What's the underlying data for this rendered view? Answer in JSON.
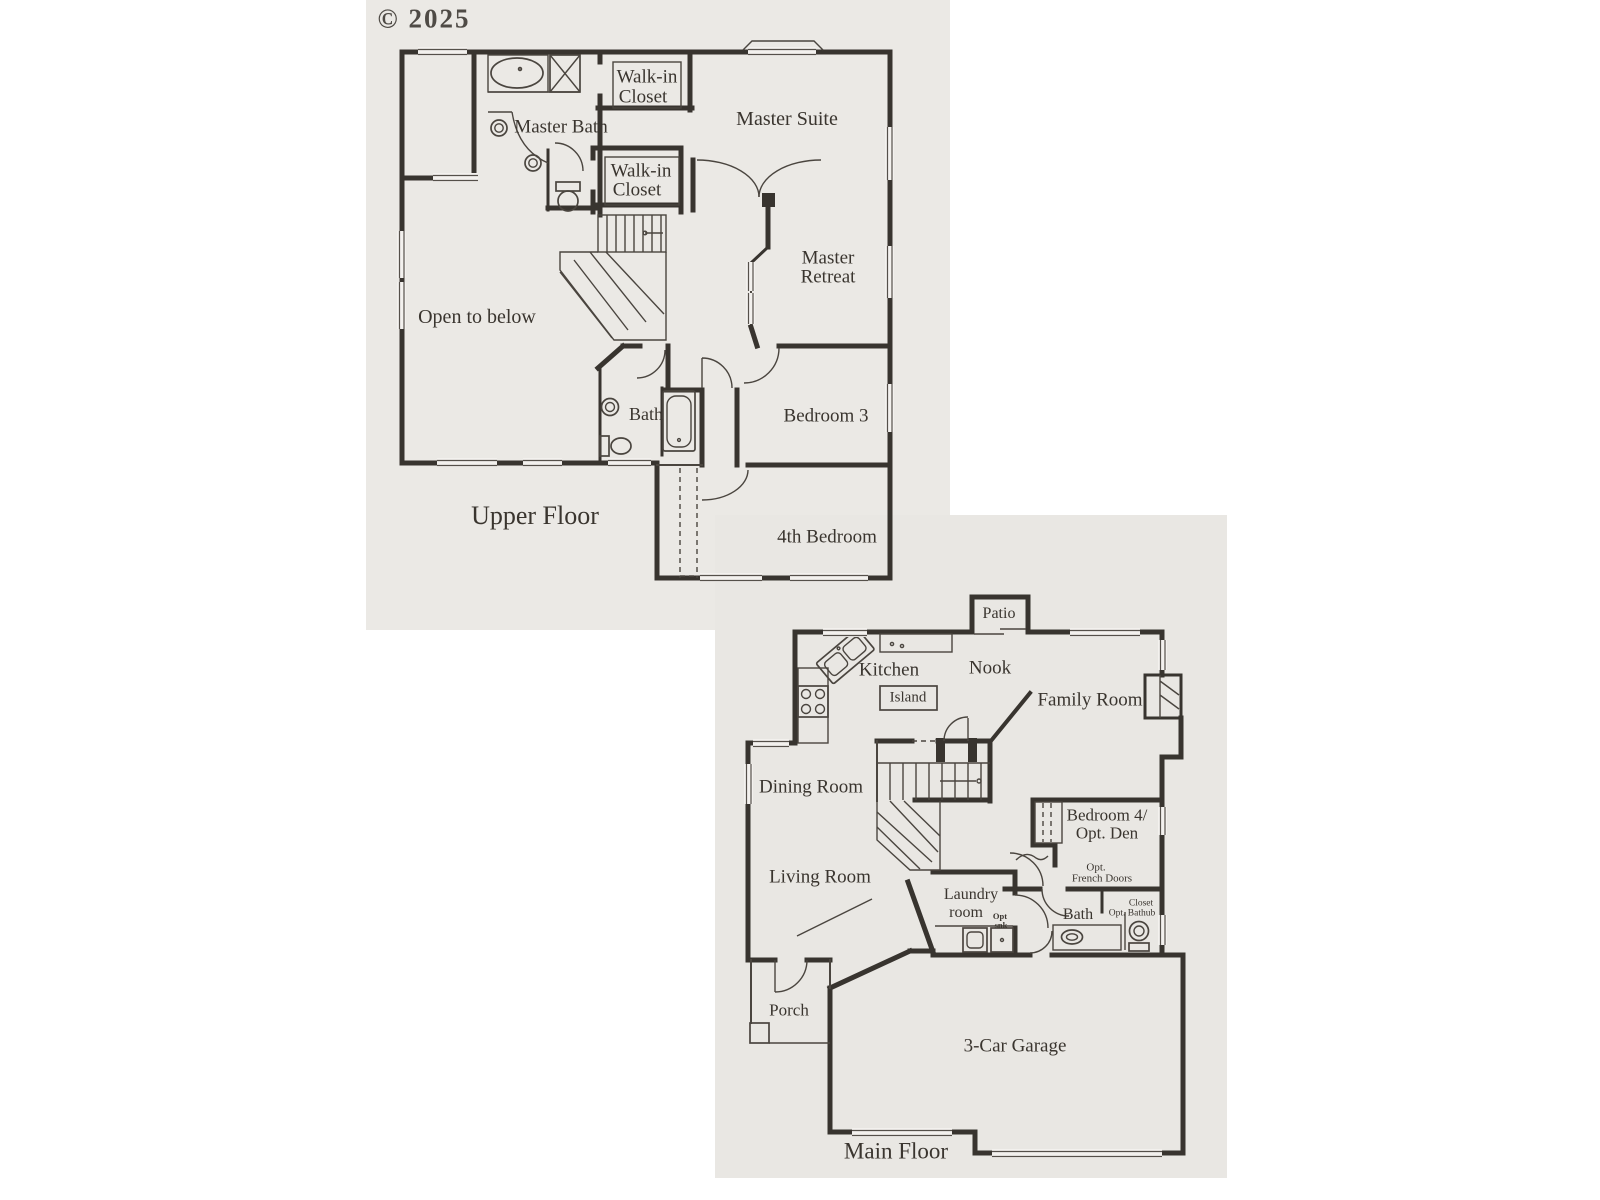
{
  "copyright": "© 2025",
  "colors": {
    "paper_upper": "#ebe9e5",
    "paper_main": "#e9e7e3",
    "ink": "#38342f",
    "text": "#3a352f"
  },
  "upper_floor": {
    "title": "Upper Floor",
    "labels": {
      "walk_in_closet_1": {
        "line1": "Walk-in",
        "line2": "Closet"
      },
      "master_bath": "Master Bath",
      "master_suite": "Master Suite",
      "walk_in_closet_2": {
        "line1": "Walk-in",
        "line2": "Closet"
      },
      "master_retreat": {
        "line1": "Master",
        "line2": "Retreat"
      },
      "open_to_below": "Open to below",
      "bath": "Bath",
      "bedroom_3": "Bedroom 3",
      "bedroom_4th": "4th Bedroom"
    }
  },
  "main_floor": {
    "title": "Main Floor",
    "labels": {
      "patio": "Patio",
      "kitchen": "Kitchen",
      "nook": "Nook",
      "island": "Island",
      "family_room": "Family Room",
      "dining_room": "Dining Room",
      "bedroom_4": {
        "line1": "Bedroom 4/",
        "line2": "Opt. Den"
      },
      "opt_french_doors": {
        "line1": "Opt.",
        "line2": "French Doors"
      },
      "living_room": "Living Room",
      "laundry_room": {
        "line1": "Laundry",
        "line2": "room"
      },
      "opt_sink": {
        "line1": "Opt",
        "line2": "snk"
      },
      "bath": "Bath",
      "closet": "Closet",
      "opt_bathtub": "Opt. Bathub",
      "porch": "Porch",
      "garage": "3-Car Garage"
    }
  }
}
